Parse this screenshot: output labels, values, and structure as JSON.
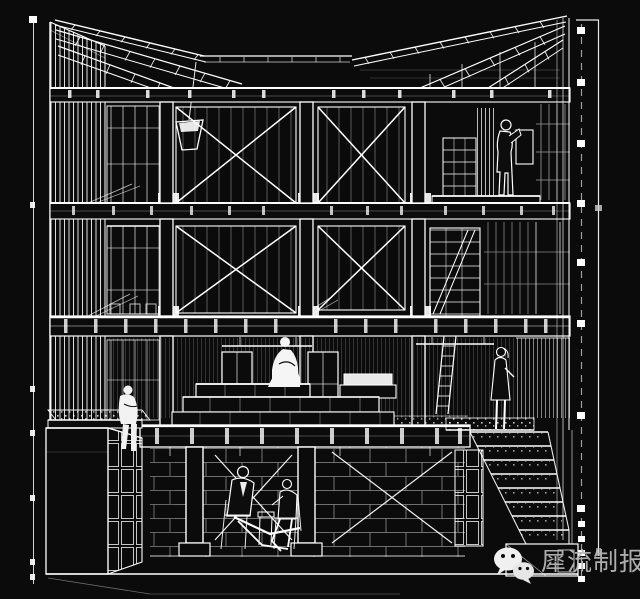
{
  "page": {
    "background_color": "#0b0b0b",
    "line_color": "#ffffff"
  },
  "drawing": {
    "kind": "architectural sectional perspective wireframe",
    "description": "White line drawing on black: three-storey timber/steel frame with X-braced bays, fanned roof joists, window mullion walls, tiered central platform, right-side cascading stairs, left roof terrace with planter and storage volume, basement lounge with two seated figures, plus survey dimension lines on both edges."
  },
  "watermark": {
    "text": "犀流制报",
    "text_color": "#b6b6b6",
    "icon": "wechat-icon",
    "icon_color": "#efefef"
  }
}
